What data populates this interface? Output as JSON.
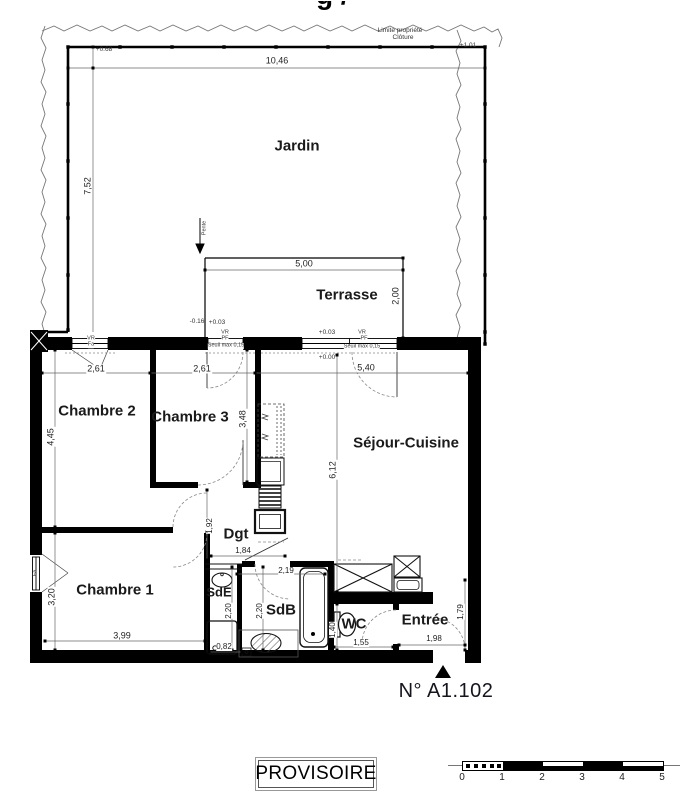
{
  "title_fragment": "g /",
  "site": {
    "limite_propriete": "Limite propriété",
    "cloture": "Clôture",
    "pente": "Pente"
  },
  "levels": {
    "garden_left": "+0.68",
    "garden_right": "+1.01",
    "terrace_out": "-0.16",
    "terrace_in": "+0.03",
    "window_in": "+0.03",
    "floor": "+0.00",
    "seuil_a": "Seuil max 0,15",
    "seuil_b": "Seuil max 0,15"
  },
  "rooms": {
    "jardin": "Jardin",
    "terrasse": "Terrasse",
    "chambre2": "Chambre 2",
    "chambre3": "Chambre 3",
    "sejour": "Séjour-Cuisine",
    "dgt": "Dgt",
    "chambre1": "Chambre 1",
    "sde": "SdE",
    "sdb": "SdB",
    "wc": "WC",
    "entree": "Entrée"
  },
  "dims": {
    "jardin_w": "10,46",
    "jardin_h": "7,52",
    "terrasse_w": "5,00",
    "terrasse_h": "2,00",
    "ch2_w": "2,61",
    "ch3_w": "2,61",
    "sejour_w": "5,40",
    "ch2_h": "4,45",
    "ch3_h": "3,48",
    "sejour_h": "6,12",
    "dgt_h": "1,92",
    "dgt_w": "1,84",
    "sdb_w": "2,19",
    "ch1_w": "3,99",
    "ch1_h": "3,20",
    "sde_h": "2,20",
    "sdb_h": "2,20",
    "sde_w": "0,82",
    "wc_w": "1,55",
    "wc_h": "1,40",
    "entree_w": "1,98",
    "entree_h": "1,79"
  },
  "window_tags": {
    "w1_top": "VR",
    "w1_bottom": "Fa",
    "w2_top": "VR",
    "w2_bottom": "PF",
    "w3_top": "VR",
    "w3_bottom": "PF",
    "w4": "Fa"
  },
  "plan_number": "N° A1.102",
  "stamp": "PROVISOIRE",
  "scalebar": {
    "ticks": [
      "0",
      "1",
      "2",
      "3",
      "4",
      "5"
    ]
  }
}
